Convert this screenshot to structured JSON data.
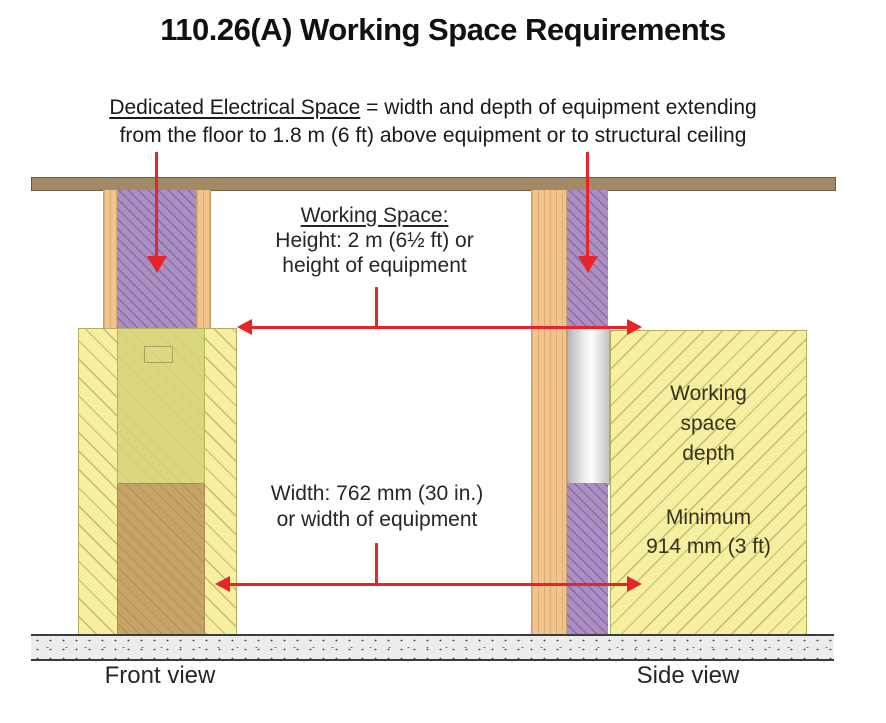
{
  "title": "110.26(A) Working Space Requirements",
  "definition": {
    "term": "Dedicated Electrical Space",
    "line1_rest": " = width and depth of equipment extending",
    "line2": "from the floor to 1.8 m (6 ft) above equipment or to structural ceiling"
  },
  "working_space_label": {
    "heading": "Working Space:",
    "line1": "Height: 2 m (6½ ft) or",
    "line2": "height of equipment"
  },
  "width_label": {
    "line1": "Width: 762 mm (30 in.)",
    "line2": "or width of equipment"
  },
  "side_view_labels": {
    "depth_line1": "Working",
    "depth_line2": "space",
    "depth_line3": "depth",
    "minimum_line1": "Minimum",
    "minimum_line2": "914 mm (3 ft)"
  },
  "view_labels": {
    "front": "Front view",
    "side": "Side view"
  },
  "colors": {
    "annotation_red": "#e8232a",
    "ceiling_brown": "#a28a66",
    "wood_orange": "#f2c38c",
    "dedicated_space_purple": "#ab8fc2",
    "working_space_yellow": "#f5ef9f",
    "equipment_front_panel": "#dcd67f",
    "equipment_base_brown": "#c6a366",
    "equipment_side_gray": "#d9d9db",
    "floor_gray": "#ececec"
  }
}
